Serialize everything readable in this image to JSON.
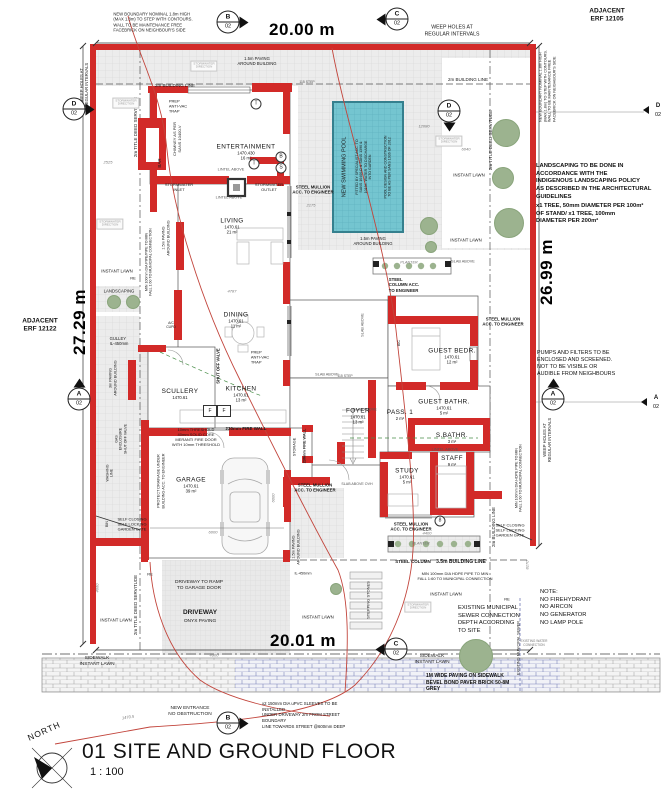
{
  "title_block": {
    "number_and_name": "01 SITE AND GROUND FLOOR",
    "scale": "1 : 100",
    "north_label": "NORTH"
  },
  "dimensions": {
    "top": "20.00 m",
    "bottom": "20.01 m",
    "left": "27.29 m",
    "right": "26.99 m"
  },
  "adjacent": {
    "top_right": "ADJACENT\nERF 12105",
    "left": "ADJACENT\nERF 12122"
  },
  "notes": {
    "landscaping": "LANDSCAPING TO BE DONE IN\nACCORDANCE WITH THE\nINDIGENOUS LANDSCAPING POLICY\nAS DESCRIBED IN THE ARCHITECTURAL\nGUIDELINES",
    "trees_note": "x1 TREE, 50mm DIAMETER PER 100m²\nOF STAND/ x1 TREE, 100mm\nDIAMETER PER 200m²",
    "pumps": "PUMPS AND FILTERS TO BE\nENCLOSED AND SCREENED.\nNOT TO BE VISIBLE OR\nAUDIBLE FROM NEIGHBOURS",
    "site_note": "NOTE:\nNO FIREHYDRANT\nNO AIRCON\nNO GENERATOR\nNO LAMP POLE",
    "sewer": "EXISTING MUNICIPAL\nSEWER CONNECTION\nDEPTH ACCORDING\nTO SITE",
    "paving": "1M WIDE PAVING ON SIDEWALK\nBEVEL BOND PAVER BRICK 50-8M\nGREY",
    "sleeves": "x2 150mm DIA uPVC SLEEVES TO BE INSTALLED\nUNDER DRIVEWAY 2m FROM STREET BOUNDARY\nLINE TOWARDS STREET @600mm DEEP"
  },
  "rooms": [
    {
      "name": "ENTERTAINMENT",
      "level": "1470.430",
      "area": "16 m²",
      "x": 246,
      "y": 152
    },
    {
      "name": "LIVING",
      "level": "1470.61",
      "area": "21 m²",
      "x": 232,
      "y": 226
    },
    {
      "name": "DINING",
      "level": "1470.61",
      "area": "11 m²",
      "x": 236,
      "y": 320
    },
    {
      "name": "KITCHEN",
      "level": "1470.61",
      "area": "13 m²",
      "x": 241,
      "y": 394
    },
    {
      "name": "SCULLERY",
      "level": "1470.61",
      "area": "",
      "x": 180,
      "y": 394
    },
    {
      "name": "GARAGE",
      "level": "1470.61",
      "area": "39 m²",
      "x": 191,
      "y": 485
    },
    {
      "name": "FOYER",
      "level": "1470.61",
      "area": "13 m²",
      "x": 358,
      "y": 416
    },
    {
      "name": "PASS. 1",
      "level": "",
      "area": "2 m²",
      "x": 400,
      "y": 415
    },
    {
      "name": "GUEST BEDR.",
      "level": "1470.61",
      "area": "12 m²",
      "x": 452,
      "y": 356
    },
    {
      "name": "GUEST BATHR.",
      "level": "1470.61",
      "area": "5 m²",
      "x": 444,
      "y": 407
    },
    {
      "name": "S.BATHR.",
      "level": "",
      "area": "3 m²",
      "x": 452,
      "y": 438
    },
    {
      "name": "STUDY",
      "level": "1470.61",
      "area": "5 m²",
      "x": 407,
      "y": 476
    },
    {
      "name": "STAFF",
      "level": "",
      "area": "9 m²",
      "x": 452,
      "y": 461
    }
  ],
  "section_markers": [
    {
      "letter": "B",
      "num": "02",
      "x": 228,
      "y": 22,
      "tri": "r"
    },
    {
      "letter": "C",
      "num": "02",
      "x": 397,
      "y": 19,
      "tri": "l"
    },
    {
      "letter": "D",
      "num": "02",
      "x": 74,
      "y": 109,
      "tri": "r"
    },
    {
      "letter": "D",
      "num": "02",
      "x": 449,
      "y": 111,
      "tri": "d"
    },
    {
      "letter": "A",
      "num": "02",
      "x": 79,
      "y": 399,
      "tri": "u"
    },
    {
      "letter": "A",
      "num": "02",
      "x": 553,
      "y": 399,
      "tri": "u"
    },
    {
      "letter": "C",
      "num": "02",
      "x": 396,
      "y": 649,
      "tri": "l"
    },
    {
      "letter": "B",
      "num": "02",
      "x": 228,
      "y": 723,
      "tri": "r"
    },
    {
      "letter": "D",
      "num": "02",
      "x": 658,
      "y": 110,
      "tri": "l",
      "small": true
    },
    {
      "letter": "A",
      "num": "02",
      "x": 656,
      "y": 402,
      "tri": "l",
      "small": true
    }
  ],
  "trees": [
    [
      506,
      133,
      13
    ],
    [
      503,
      178,
      10
    ],
    [
      509,
      223,
      14
    ],
    [
      476,
      656,
      16
    ],
    [
      429,
      226,
      8
    ],
    [
      431,
      247,
      5
    ],
    [
      114,
      302,
      6
    ],
    [
      133,
      302,
      6
    ],
    [
      336,
      589,
      5
    ]
  ],
  "annotations": [
    {
      "n": "building-line-top-left",
      "t": "2m BUILDING LINE",
      "x": 175,
      "y": 86,
      "s": 4.5
    },
    {
      "n": "building-line-top-right",
      "t": "2m BUILDING LINE",
      "x": 468,
      "y": 80,
      "s": 4.5
    },
    {
      "n": "building-line-right",
      "t": "2m BUILDING LINE",
      "x": 494,
      "y": 527,
      "s": 4.5,
      "r": -90
    },
    {
      "n": "building-line-35",
      "t": "3.5m BUILDING LINE",
      "x": 461,
      "y": 562,
      "s": 5,
      "b": 1
    },
    {
      "n": "steel-column-bottom",
      "t": "STEEL COLUMN",
      "x": 413,
      "y": 562,
      "s": 4.5,
      "b": 1
    },
    {
      "n": "title-deed-servitude-left",
      "t": "2m TITLE DEED SERVITUDE",
      "x": 136,
      "y": 127,
      "s": 4.5,
      "r": -90
    },
    {
      "n": "title-deed-servitude-left-bottom",
      "t": "2m TITLE DEED SERVITUDE",
      "x": 136,
      "y": 605,
      "s": 4.5,
      "r": -90
    },
    {
      "n": "title-deed-servitude-right",
      "t": "2m TITLE DEED SERVITUDE",
      "x": 491,
      "y": 140,
      "s": 4.5,
      "r": -90
    },
    {
      "n": "weep-holes-left",
      "t": "WEEP HOLES AT\nREGULAR INTERVALS",
      "x": 84,
      "y": 85,
      "s": 4.2,
      "r": -90
    },
    {
      "n": "weep-holes-top-right",
      "t": "WEEP HOLES AT\nREGULAR INTERVALS",
      "x": 452,
      "y": 31,
      "s": 5.2
    },
    {
      "n": "weep-holes-right",
      "t": "WEEP HOLES AT\nREGULAR INTERVALS",
      "x": 547,
      "y": 440,
      "s": 4.2,
      "r": -90
    },
    {
      "n": "boundary-note-top-left",
      "t": "NEW BOUNDARY NOMINAL 1.8m HIGH\n(MAX 1.8m) TO STEP WITH CONTOURS.\nWALL TO BE MAINTENANCE FREE\nFACEBRICK ON NEIGHBOUR'S SIDE",
      "x": 153,
      "y": 22,
      "s": 4.2,
      "al": "left"
    },
    {
      "n": "boundary-note-right",
      "t": "NEW BOUNDARY NOMINAL 1.8m HIGH\n(MAX 1.8m) TO STEP WITH CONTOURS.\nWALL TO BE MAINTENANCE FREE\nFACEBRICK ON NEIGHBOUR'S SIDE",
      "x": 548,
      "y": 86,
      "s": 3.8,
      "r": -90,
      "al": "left"
    },
    {
      "n": "paving-note-top",
      "t": "1.5m PAVING\nAROUND BUILDING",
      "x": 257,
      "y": 61,
      "s": 4.2
    },
    {
      "n": "paving-note-pool",
      "t": "1.5m PAVING\nAROUND BUILDING",
      "x": 373,
      "y": 241,
      "s": 4.2
    },
    {
      "n": "paving-note-left",
      "t": "1.5m PAVING\nAROUND BUILDING",
      "x": 166,
      "y": 238,
      "s": 3.8,
      "r": -90
    },
    {
      "n": "paving-note-garage",
      "t": "1.5m PAVING\nAROUND BUILDING",
      "x": 296,
      "y": 547,
      "s": 3.8,
      "r": -90
    },
    {
      "n": "paving-note-3m",
      "t": "3m PAVING\nAROUND BUILDING",
      "x": 113,
      "y": 378,
      "s": 3.8,
      "r": -90
    },
    {
      "n": "prep-antivac-top",
      "t": "PREP\nANTI-VAC\nTRAP",
      "x": 178,
      "y": 106,
      "s": 4,
      "al": "left"
    },
    {
      "n": "prep-antivac-dining",
      "t": "PREP\nANTI-VAC\nTRAP",
      "x": 260,
      "y": 357,
      "s": 4,
      "al": "left"
    },
    {
      "n": "chimney-note",
      "t": "CHIMNEY AS PER\nSANS 10400-V",
      "x": 177,
      "y": 139,
      "s": 4,
      "r": -90
    },
    {
      "n": "bar-label",
      "t": "BAR",
      "x": 160,
      "y": 163,
      "s": 4.5,
      "r": -90
    },
    {
      "n": "lintel-above-1",
      "t": "LINTEL ABOVE",
      "x": 231,
      "y": 170,
      "s": 3.8,
      "c": "#555"
    },
    {
      "n": "lintel-above-2",
      "t": "LINTEL ABOVE",
      "x": 229,
      "y": 198,
      "s": 3.8,
      "c": "#555"
    },
    {
      "n": "lintel-above-3",
      "t": "LINTEL ABOVE",
      "x": 445,
      "y": 450,
      "s": 3.8,
      "c": "#555"
    },
    {
      "n": "stormwater-inlet",
      "t": "STORMWATER\nINLET",
      "x": 179,
      "y": 187,
      "s": 4
    },
    {
      "n": "stormwater-outlet",
      "t": "STORMWATER\nOUTLET",
      "x": 269,
      "y": 187,
      "s": 4
    },
    {
      "n": "steel-mullion-top",
      "t": "STEEL MULLION\nACC. TO ENGINEER",
      "x": 313,
      "y": 190,
      "s": 4.3,
      "b": 1
    },
    {
      "n": "steel-mullion-foyer",
      "t": "STEEL MULLION\nACC. TO ENGINEER",
      "x": 315,
      "y": 488,
      "s": 4.3,
      "b": 1
    },
    {
      "n": "steel-mullion-study",
      "t": "STEEL MULLION\nACC. TO ENGINEER",
      "x": 411,
      "y": 527,
      "s": 4.3,
      "b": 1
    },
    {
      "n": "steel-mullion-right",
      "t": "STEEL MULLION\nACC. TO ENGINEER",
      "x": 503,
      "y": 322,
      "s": 4.3,
      "b": 1
    },
    {
      "n": "steel-column-planter",
      "t": "STEEL\nCOLUMN ACC.\nTO ENGINEER",
      "x": 404,
      "y": 285,
      "s": 4.3,
      "b": 1,
      "al": "left"
    },
    {
      "n": "pool-title",
      "t": "NEW SWIMMING POOL",
      "x": 345,
      "y": 167,
      "s": 5.5,
      "r": -90
    },
    {
      "n": "pool-spec",
      "t": "FITTED BY SPECIALIST ACC. TO\nSANS 10400-D & SANS 1390 &\n10134. WATER TO DISCHARGE\nINTO GARDEN",
      "x": 364,
      "y": 167,
      "s": 3.6,
      "r": -90
    },
    {
      "n": "pool-design",
      "t": "POOL DESIGN AND CONSTRUCTION\nTO BE AS PER SANS 1936 OF 2012",
      "x": 388,
      "y": 167,
      "s": 3.6,
      "r": -90
    },
    {
      "n": "instant-lawn-right-1",
      "t": "INSTANT LAWN",
      "x": 469,
      "y": 175,
      "s": 4.3
    },
    {
      "n": "instant-lawn-right-2",
      "t": "INSTANT LAWN",
      "x": 466,
      "y": 240,
      "s": 4.3
    },
    {
      "n": "instant-lawn-left",
      "t": "INSTANT LAWN",
      "x": 117,
      "y": 271,
      "s": 4.3
    },
    {
      "n": "landscaping-left",
      "t": "LANDSCAPING",
      "x": 119,
      "y": 291,
      "s": 4.3
    },
    {
      "n": "instant-lawn-bottom-1",
      "t": "INSTANT LAWN",
      "x": 116,
      "y": 620,
      "s": 4.3
    },
    {
      "n": "instant-lawn-bottom-2",
      "t": "INSTANT LAWN",
      "x": 318,
      "y": 617,
      "s": 4.3
    },
    {
      "n": "instant-lawn-bottom-3",
      "t": "INSTANT LAWN",
      "x": 446,
      "y": 594,
      "s": 4.3
    },
    {
      "n": "sidewalk-left",
      "t": "SIDEWALK\nINSTANT LAWN",
      "x": 97,
      "y": 662,
      "s": 4.8
    },
    {
      "n": "sidewalk-right",
      "t": "SIDEWALK\nINSTANT LAWN",
      "x": 432,
      "y": 660,
      "s": 4.8
    },
    {
      "n": "min-pipe-left",
      "t": "MIN 100mm DIA PIPE/PIPE TO MIN\nFALL 1:60 TO MUNICIPAL CONNECTION",
      "x": 149,
      "y": 262,
      "s": 3.6,
      "r": -90
    },
    {
      "n": "min-pipe-right",
      "t": "MIN 100mm DIA HDPE PIPE TO MIN\nFALL 1:60 TO MUNICIPAL CONNECTION",
      "x": 519,
      "y": 478,
      "s": 3.6,
      "r": -90
    },
    {
      "n": "min-pipe-bottom",
      "t": "MIN 100mm DIA HDPE PIPE TO MIN\nFALL 1:60 TO MUNICIPAL CONNECTION",
      "x": 455,
      "y": 576,
      "s": 4
    },
    {
      "n": "gulley",
      "t": "GULLEY\nIL-450mm",
      "x": 119,
      "y": 341,
      "s": 4.2,
      "al": "left"
    },
    {
      "n": "shut-off-valve",
      "t": "SHUT OFF VALVE",
      "x": 218,
      "y": 366,
      "s": 4.2,
      "b": 1,
      "r": -90
    },
    {
      "n": "gas-enclosure",
      "t": "GAS\nENCLOSURE\nSHUT OFF VALVE",
      "x": 121,
      "y": 439,
      "s": 3.6,
      "r": -90
    },
    {
      "n": "washing-line",
      "t": "WASHING\nLINE",
      "x": 110,
      "y": 473,
      "s": 3.6,
      "r": -90
    },
    {
      "n": "bin",
      "t": "BIN",
      "x": 107,
      "y": 524,
      "s": 3.6,
      "r": -90
    },
    {
      "n": "protect-drainage",
      "t": "PROTECT DRAINAGE UNDER\nBUILDING ACC. TO ENGINEER",
      "x": 161,
      "y": 481,
      "s": 3.8,
      "r": -90
    },
    {
      "n": "garden-gate-left",
      "t": "SELF CLOSING\nSELF LOCKING\nGARDEN GATE",
      "x": 132,
      "y": 524,
      "s": 4
    },
    {
      "n": "garden-gate-right",
      "t": "SELF CLOSING\nSELF LOCKING\nGARDEN GATE",
      "x": 510,
      "y": 530,
      "s": 4
    },
    {
      "n": "fire-door-note",
      "t": "10mm THRESHOLD\n40mm SOLID CORE\nMERANTI FIRE DOOR\nWITH 10mm THRESHOLD",
      "x": 196,
      "y": 437,
      "s": 4
    },
    {
      "n": "fire-wall-h",
      "t": "230mm FIRE WALL",
      "x": 246,
      "y": 429,
      "s": 4.5,
      "b": 1
    },
    {
      "n": "fire-wall-v",
      "t": "230mm FIRE WALL",
      "x": 305,
      "y": 446,
      "s": 3.8,
      "r": -90,
      "b": 1
    },
    {
      "n": "storage",
      "t": "STORAGE",
      "x": 295,
      "y": 447,
      "s": 3.8,
      "r": -90
    },
    {
      "n": "stepping-stones",
      "t": "STEPPING STONES",
      "x": 368,
      "y": 600,
      "s": 4,
      "r": -90
    },
    {
      "n": "driveway-ramp",
      "t": "DRIVEWAY TO RAMP\nTO GARAGE DOOR",
      "x": 199,
      "y": 586,
      "s": 4.8
    },
    {
      "n": "driveway-title",
      "t": "DRIVEWAY",
      "x": 200,
      "y": 613,
      "s": 6.5,
      "b": 1
    },
    {
      "n": "driveway-sub",
      "t": "ONYX PAVING",
      "x": 200,
      "y": 622,
      "s": 4.8
    },
    {
      "n": "municipal-sewer",
      "t": "EXISTING MUNICIPAL SEWER",
      "x": 519,
      "y": 648,
      "s": 3.8,
      "r": -90
    },
    {
      "n": "new-entrance",
      "t": "NEW ENTRANCE\nNO OBSTRUCTION",
      "x": 190,
      "y": 712,
      "s": 4.8
    },
    {
      "n": "ac-cupd",
      "t": "A/C\nCUPD",
      "x": 171,
      "y": 325,
      "s": 3.4
    },
    {
      "n": "re-1",
      "t": "RE",
      "x": 133,
      "y": 278,
      "s": 4
    },
    {
      "n": "re-2",
      "t": "RE",
      "x": 507,
      "y": 599,
      "s": 4
    },
    {
      "n": "re-3",
      "t": "RE",
      "x": 150,
      "y": 574,
      "s": 4
    },
    {
      "n": "il-450",
      "t": "IL-450mm",
      "x": 303,
      "y": 574,
      "s": 3.8
    },
    {
      "n": "slab-above-1",
      "t": "SLAB ABOVE",
      "x": 327,
      "y": 375,
      "s": 3.8,
      "c": "#555"
    },
    {
      "n": "slab-above-2",
      "t": "SLAB ABOVE",
      "x": 365,
      "y": 410,
      "s": 3.8,
      "c": "#555"
    },
    {
      "n": "slab-above-3",
      "t": "SLAB ABOVE",
      "x": 463,
      "y": 262,
      "s": 3.8,
      "c": "#555"
    },
    {
      "n": "slab-above-4",
      "t": "SLAB ABOVE",
      "x": 363,
      "y": 325,
      "s": 3.8,
      "r": -90,
      "c": "#555"
    },
    {
      "n": "slab-above-5",
      "t": "SLAB ABOVE OVH",
      "x": 357,
      "y": 484,
      "s": 3.6,
      "c": "#555"
    },
    {
      "n": "step-115-1",
      "t": "115 STEP",
      "x": 307,
      "y": 82,
      "s": 3.4,
      "c": "#555"
    },
    {
      "n": "step-115-2",
      "t": "115 STEP",
      "x": 345,
      "y": 376,
      "s": 3.4,
      "c": "#555"
    },
    {
      "n": "planter-1",
      "t": "PLANTER",
      "x": 409,
      "y": 263,
      "s": 3.8,
      "cls": "dim"
    },
    {
      "n": "planter-2",
      "t": "PLANTER",
      "x": 421,
      "y": 544,
      "s": 3.8,
      "cls": "dim"
    },
    {
      "n": "bic",
      "t": "BIC",
      "x": 399,
      "y": 343,
      "s": 3.6,
      "r": -90
    },
    {
      "n": "dim-4787",
      "t": "4787",
      "x": 232,
      "y": 291,
      "s": 4,
      "cls": "dim"
    },
    {
      "n": "dim-6040",
      "t": "6040",
      "x": 466,
      "y": 149,
      "s": 4,
      "cls": "dim"
    },
    {
      "n": "dim-12080",
      "t": "12080",
      "x": 424,
      "y": 126,
      "s": 4,
      "cls": "dim"
    },
    {
      "n": "dim-6000a",
      "t": "6000",
      "x": 213,
      "y": 532,
      "s": 4,
      "cls": "dim"
    },
    {
      "n": "dim-6000b",
      "t": "6000",
      "x": 273,
      "y": 498,
      "s": 4,
      "r": -90,
      "cls": "dim"
    },
    {
      "n": "dim-4400",
      "t": "4400",
      "x": 427,
      "y": 533,
      "s": 4,
      "cls": "dim"
    },
    {
      "n": "dim-2175",
      "t": "2175",
      "x": 311,
      "y": 205,
      "s": 4,
      "cls": "dim"
    },
    {
      "n": "dim-4900",
      "t": "4900",
      "x": 214,
      "y": 655,
      "s": 4,
      "cls": "dim"
    },
    {
      "n": "dim-8170",
      "t": "8170",
      "x": 527,
      "y": 565,
      "s": 4,
      "r": -90,
      "cls": "dim"
    },
    {
      "n": "dim-2525",
      "t": "2525",
      "x": 108,
      "y": 162,
      "s": 4,
      "cls": "dim"
    },
    {
      "n": "dim-4660",
      "t": "4660",
      "x": 97,
      "y": 588,
      "s": 4,
      "r": -90,
      "cls": "dim"
    },
    {
      "n": "contour-level",
      "t": "1470.5",
      "x": 128,
      "y": 717,
      "s": 4,
      "r": -8,
      "cls": "dim"
    },
    {
      "n": "symbol-t-1",
      "t": "T",
      "x": 256,
      "y": 104,
      "s": 5,
      "cls": "circ"
    },
    {
      "n": "symbol-t-2",
      "t": "T",
      "x": 254,
      "y": 164,
      "s": 5,
      "cls": "circ"
    },
    {
      "n": "symbol-b",
      "t": "B",
      "x": 281,
      "y": 157,
      "s": 5,
      "cls": "circ"
    },
    {
      "n": "symbol-s",
      "t": "S",
      "x": 281,
      "y": 168,
      "s": 5,
      "cls": "circ"
    },
    {
      "n": "symbol-8",
      "t": "8",
      "x": 440,
      "y": 521,
      "s": 5,
      "cls": "circ"
    },
    {
      "n": "fridge-f-1",
      "t": "F",
      "x": 210,
      "y": 411,
      "s": 5,
      "cls": "box"
    },
    {
      "n": "fridge-f-2",
      "t": "F",
      "x": 224,
      "y": 411,
      "s": 5,
      "cls": "box"
    },
    {
      "n": "stormwater-dir-1",
      "t": "STORMWATER\nDIRECTION",
      "x": 126,
      "y": 103,
      "s": 3,
      "cls": "sd"
    },
    {
      "n": "stormwater-dir-2",
      "t": "STORMWATER\nDIRECTION",
      "x": 204,
      "y": 66,
      "s": 3,
      "cls": "sd"
    },
    {
      "n": "stormwater-dir-3",
      "t": "STORMWATER\nDIRECTION",
      "x": 449,
      "y": 141,
      "s": 3,
      "cls": "sd"
    },
    {
      "n": "stormwater-dir-4",
      "t": "STORMWATER\nDIRECTION",
      "x": 110,
      "y": 224,
      "s": 3,
      "cls": "sd"
    },
    {
      "n": "stormwater-dir-5",
      "t": "STORMWATER\nDIRECTION",
      "x": 418,
      "y": 607,
      "s": 3,
      "cls": "sd"
    },
    {
      "n": "existing-water",
      "t": "EXISTING WATER\nCONNECTION",
      "x": 534,
      "y": 643,
      "s": 3.2,
      "c": "#777"
    }
  ],
  "colors": {
    "wall_red": "#d22a28",
    "contour_red": "#c2453c",
    "pool_teal": "#74c5d0",
    "tree_green": "#9cb38f",
    "paving_grey": "#ececec"
  }
}
